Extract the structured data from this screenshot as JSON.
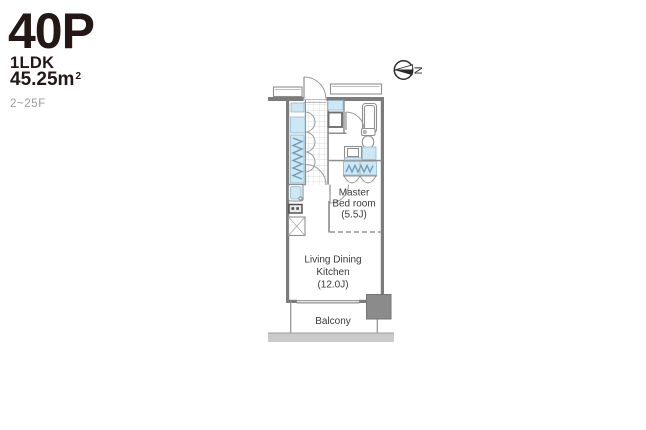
{
  "header": {
    "plan_code": "40P",
    "layout_type": "1LDK",
    "area_value": "45.25m",
    "area_sup": "2",
    "floor_range": "2~25F"
  },
  "compass": {
    "north_label": "N"
  },
  "plan": {
    "rooms": {
      "master_bedroom": {
        "line1": "Master",
        "line2": "Bed room",
        "size": "(5.5J)"
      },
      "ldk": {
        "line1": "Living Dining",
        "line2": "Kitchen",
        "size": "(12.0J)"
      },
      "balcony": {
        "label": "Balcony"
      }
    }
  },
  "colors": {
    "text-dark": "#231815",
    "floor-gray": "#9b9b9b",
    "wall-gray": "#7c7c7c",
    "line-gray": "#8f8f8f",
    "fixture-blue": "#cde7f4",
    "fixture-blue-line": "#6f9cb6",
    "pillar-gray": "#8b8b8b",
    "grid-gray": "#d4d4d4",
    "strip-gray": "#cacaca",
    "label-dark": "#3a3a3a"
  }
}
